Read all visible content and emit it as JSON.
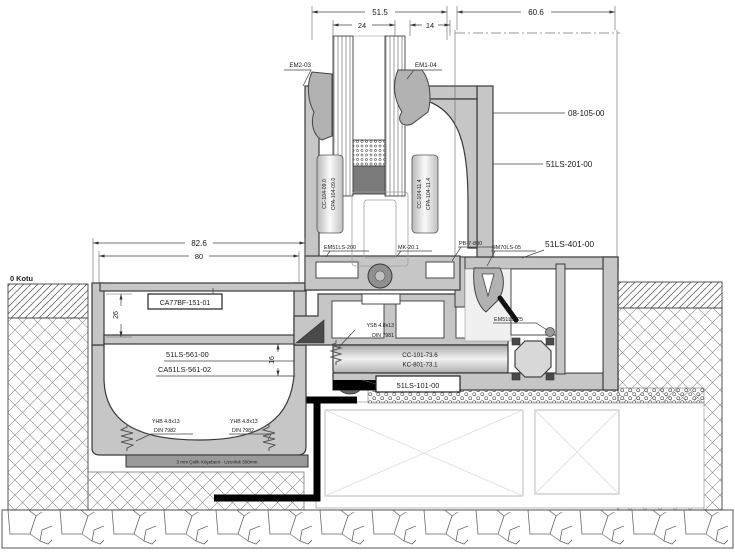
{
  "drawing": {
    "dimensions": {
      "sash_width": "51.5",
      "glazing_width": "24",
      "interlock_width": "14",
      "frame_width": "60.6",
      "channel_outer_width": "82.6",
      "channel_inner_width": "80",
      "channel_depth": "26",
      "step_height": "16"
    },
    "level_marker": "0 Kotu",
    "parts": {
      "em2_03": "EM2-03",
      "em1_04": "EM1-04",
      "p08_105": "08-105-00",
      "p51ls_201": "51LS-201-00",
      "cc104_09": "CC-104-09.0",
      "cpa104_09": "CPA-104-09.0",
      "cc104_11": "CC-104-11.4",
      "cpa104_11": "CPA-104-11.4",
      "em51ls_200": "EM51LS-200",
      "mk_20": "MK-20.1",
      "pb_7_800": "PB-7-800",
      "em70ls_05": "EM70LS-05",
      "p51ls_401": "51LS-401-00",
      "em51ls_25": "EM51LS-25",
      "ysb_screw": "YSB 4.8x13",
      "ysb_din": "DIN 7981",
      "cc101_73": "CC-101-73.6",
      "kc801_73": "KC-801-73.1",
      "cc101_17": "CC-101-17.3",
      "kc801_16": "KC-801-16.9",
      "p51ls_101": "51LS-101-00",
      "ca77bf": "CA77BF-151-01",
      "p51ls_561": "51LS-561-00",
      "ca51ls_561": "CA51LS-561-02",
      "yhb_screw": "YHB 4.8x13",
      "yhb_din": "DIN 7982",
      "steel_angle": "3 mm Çelik Köşebent - Uzunluk 300mm"
    },
    "colors": {
      "outline": "#3a3a3a",
      "profile_fill": "#c6c6c6",
      "membrane": "#000000",
      "paper": "#ffffff"
    }
  }
}
